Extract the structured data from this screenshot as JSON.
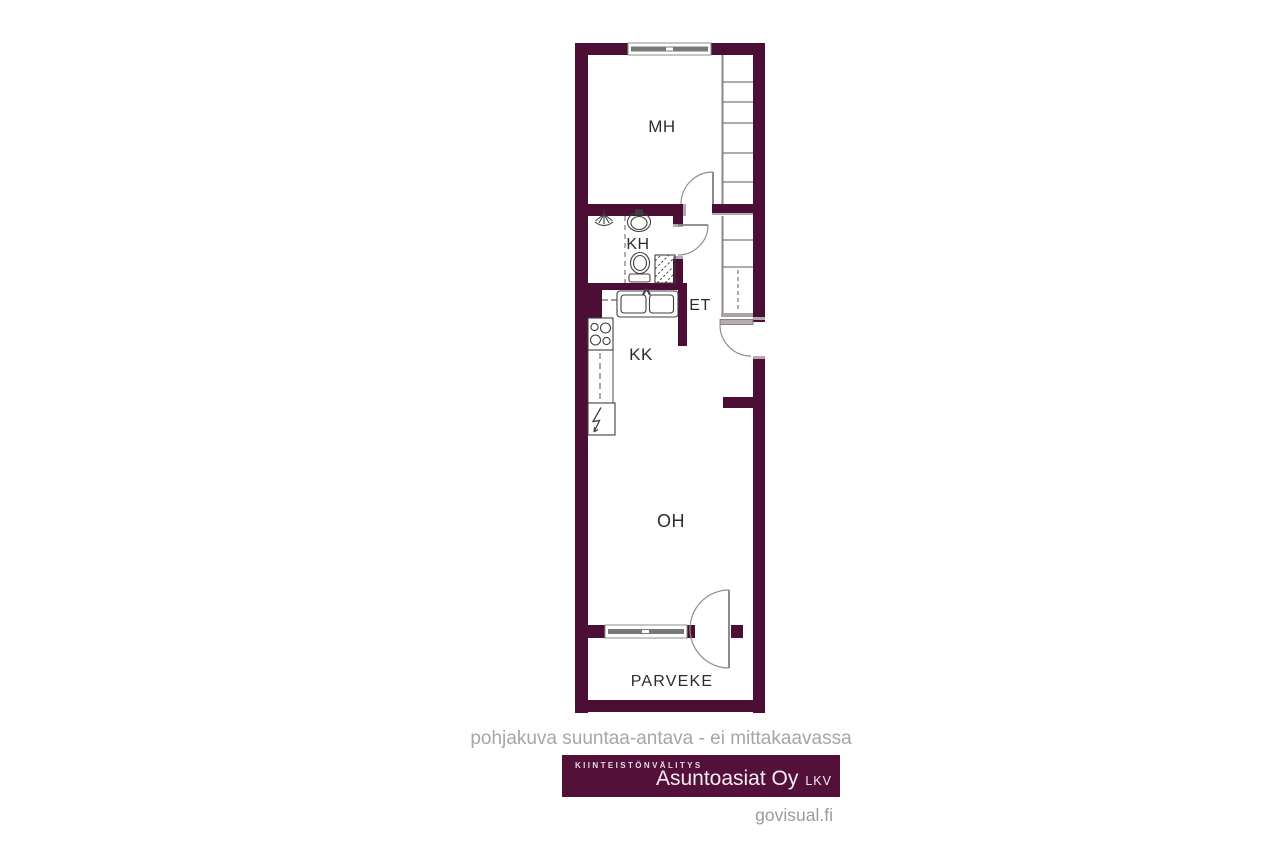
{
  "rooms": {
    "mh": {
      "label": "MH"
    },
    "kh": {
      "label": "KH"
    },
    "et": {
      "label": "ET"
    },
    "kk": {
      "label": "KK"
    },
    "oh": {
      "label": "OH"
    },
    "parveke": {
      "label": "PARVEKE"
    }
  },
  "footer": {
    "disclaimer": "pohjakuva suuntaa-antava - ei mittakaavassa",
    "credit": "govisual.fi"
  },
  "logo": {
    "tagline": "KIINTEISTÖNVÄLITYS",
    "name": "Asuntoasiat Oy",
    "suffix": "LKV"
  },
  "colors": {
    "wall": "#4c0e34",
    "logo_bg": "#531139",
    "muted": "#a6a6a6",
    "line": "#3f3f3f",
    "cap": "#b2aab0",
    "window_band": "#787878"
  },
  "icons": {
    "shower": "shower-icon",
    "washbasin": "washbasin-icon",
    "toilet": "toilet-icon",
    "washing_machine": "washing-machine-icon",
    "kitchen_sink": "kitchen-sink-icon",
    "stove": "stove-icon",
    "counter": "counter-icon",
    "fridge": "fridge-icon",
    "wardrobe": "wardrobe-shelves",
    "window": "window-symbol",
    "door": "door-swing-arc"
  }
}
